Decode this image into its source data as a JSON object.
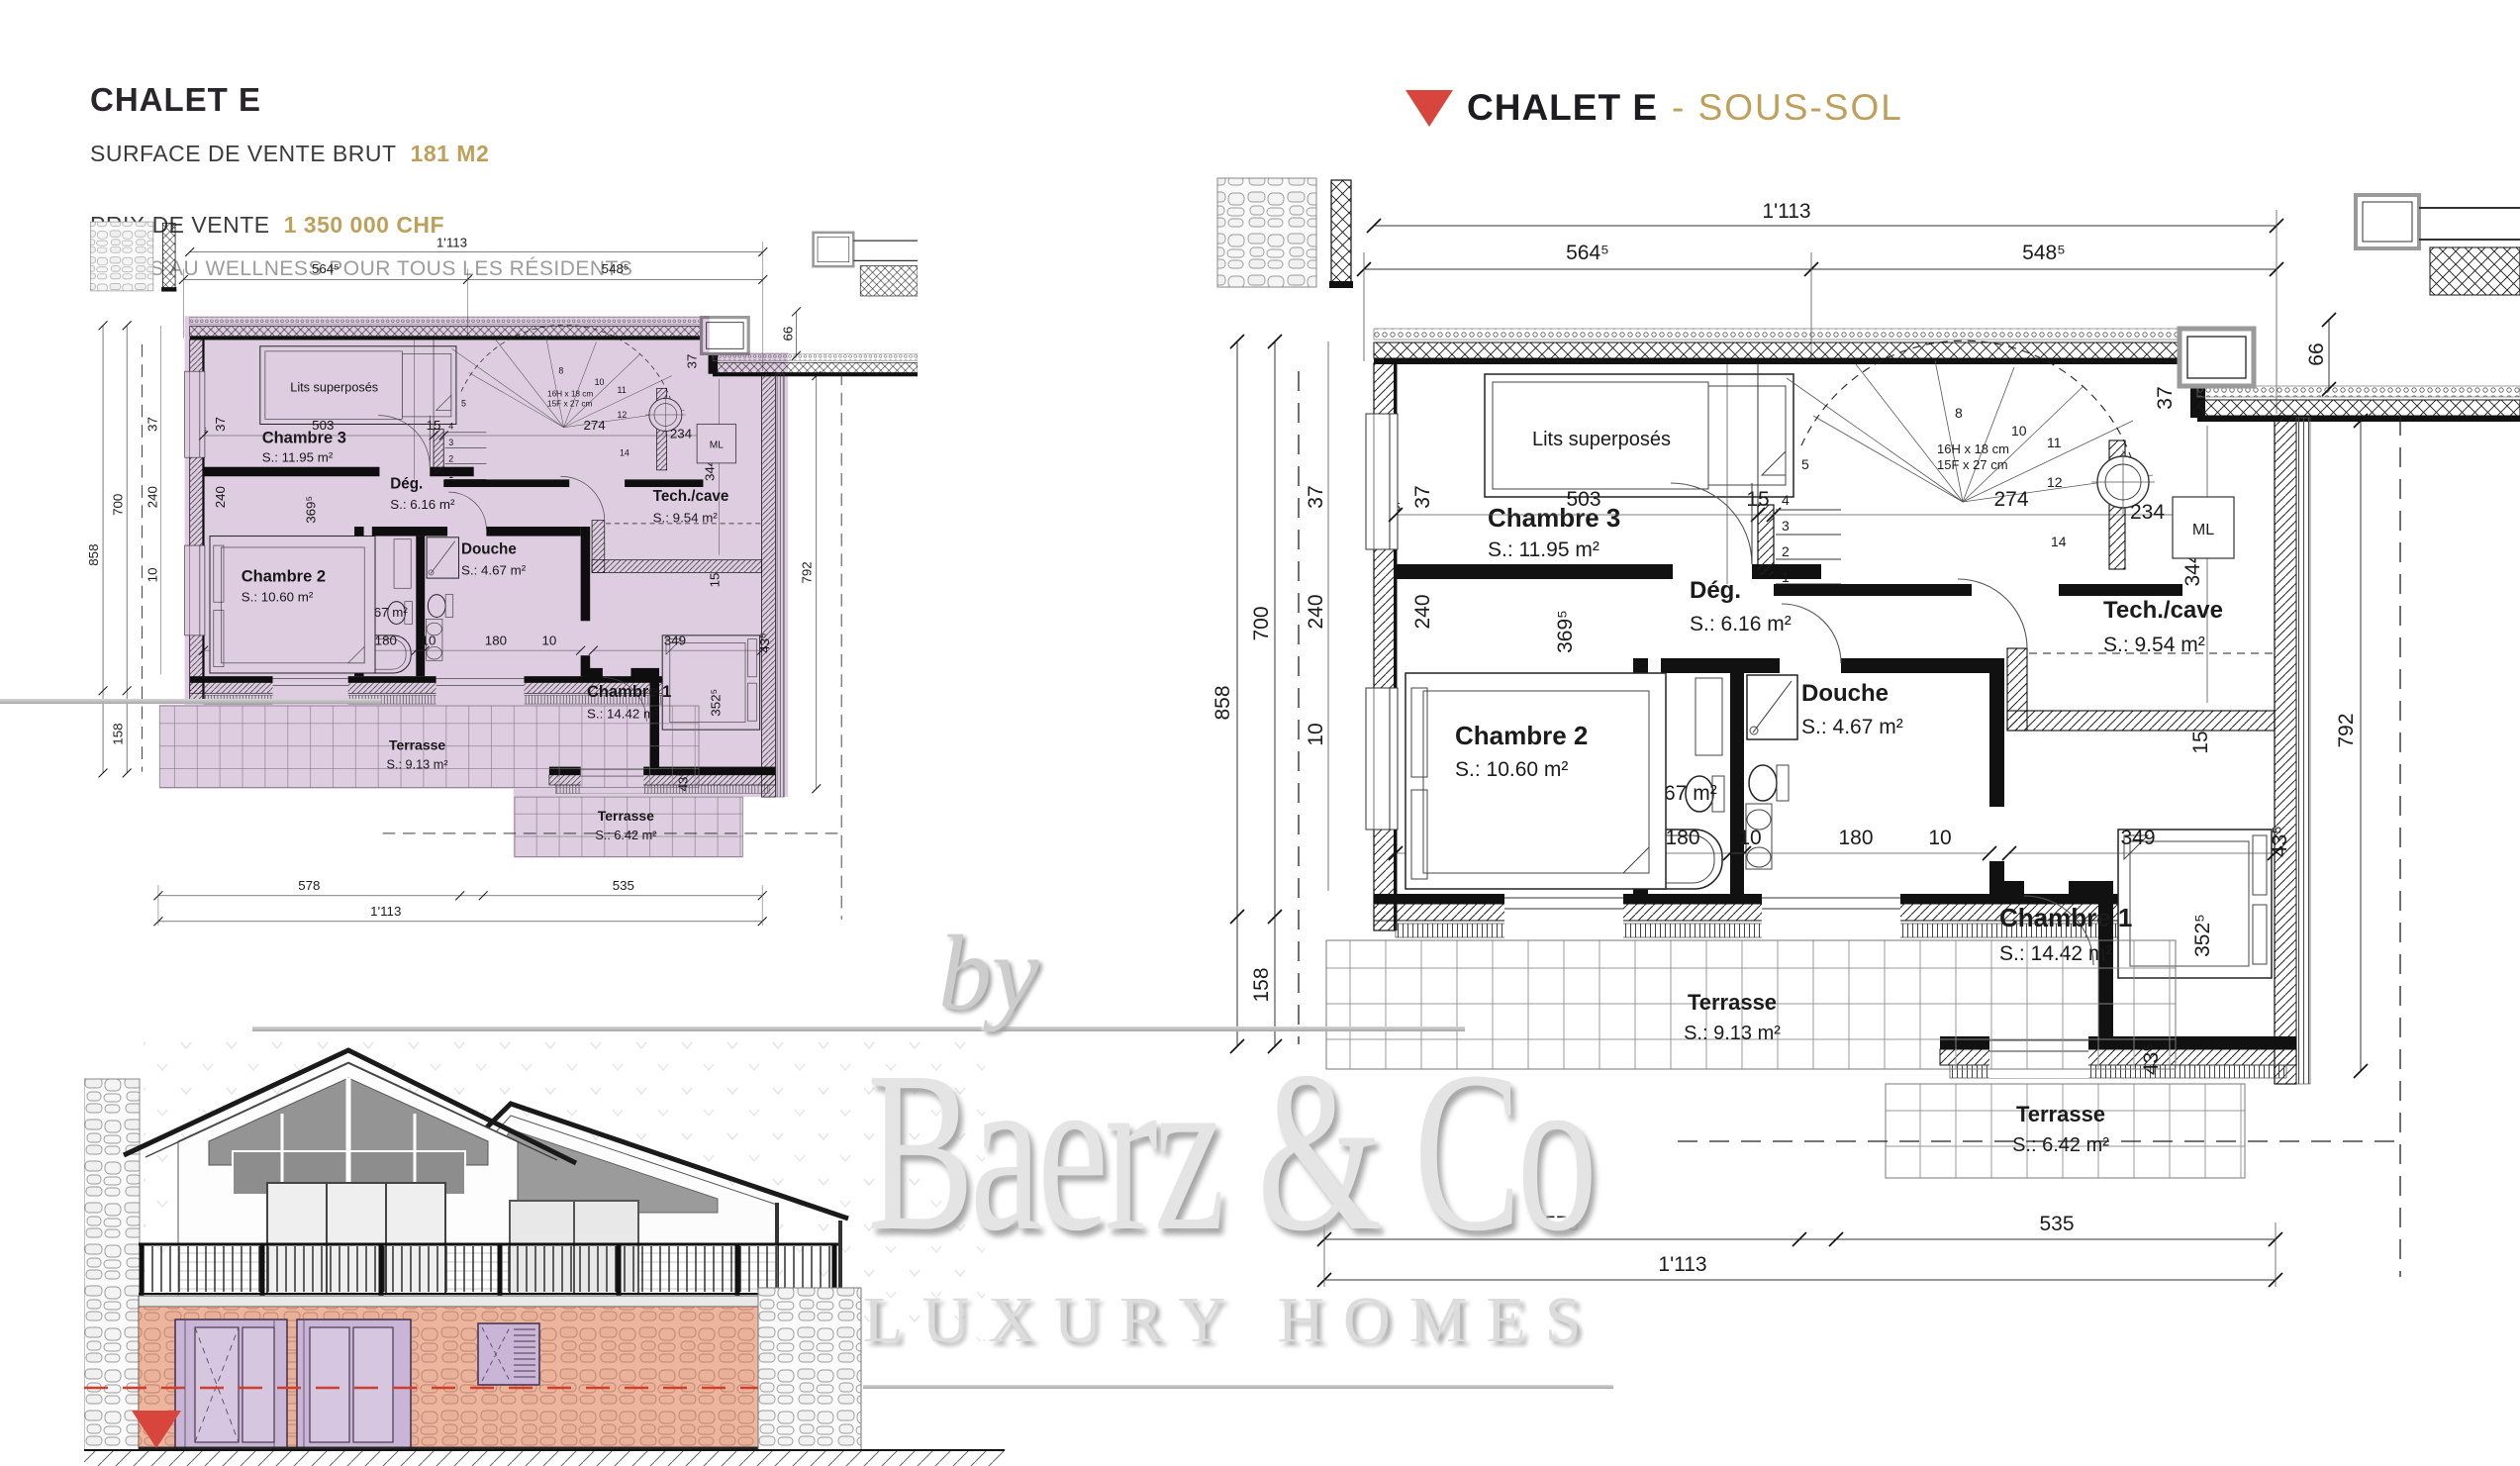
{
  "info_panel": {
    "title": "CHALET E",
    "surface_label": "SURFACE DE VENTE BRUT",
    "surface_value": "181 M2",
    "price_label": "PRIX DE VENTE",
    "price_value": "1 350 000 CHF",
    "note": "ACCÈS AU WELLNESS POUR TOUS LES RÉSIDENTS"
  },
  "plan_header": {
    "title": "CHALET E",
    "subtitle": "- SOUS-SOL"
  },
  "watermark": {
    "by": "by",
    "name": "Baerz & Co",
    "tagline": "LUXURY HOMES"
  },
  "rooms": {
    "chambre3": {
      "name": "Chambre 3",
      "area": "S.: 11.95 m²"
    },
    "chambre2": {
      "name": "Chambre 2",
      "area": "S.: 10.60 m²"
    },
    "chambre1": {
      "name": "Chambre 1",
      "area": "S.: 14.42 m²"
    },
    "bain": {
      "name": "Bain",
      "area": "S.: 4.67 m²"
    },
    "douche": {
      "name": "Douche",
      "area": "S.: 4.67 m²"
    },
    "degagement": {
      "name": "Dég.",
      "area": "S.: 6.16 m²"
    },
    "tech": {
      "name": "Tech./cave",
      "area": "S.: 9.54 m²"
    },
    "terrasse1": {
      "name": "Terrasse",
      "area": "S.: 9.13 m²"
    },
    "terrasse2": {
      "name": "Terrasse",
      "area": "S.: 6.42 m²"
    }
  },
  "annotations": {
    "bunk_beds": "Lits superposés",
    "washing_machine": "ML",
    "stair_note1": "16H x 18 cm",
    "stair_note2": "15F x 27 cm"
  },
  "dims": {
    "total": "1'113",
    "left": "564⁵",
    "right": "548⁵",
    "d66": "66",
    "d37": "37",
    "d240": "240",
    "d10": "10",
    "d43": "43⁵",
    "d700": "700",
    "d858": "858",
    "d158": "158",
    "d369": "369⁵",
    "d503": "503",
    "d15": "15",
    "d274": "274",
    "d234": "234",
    "d287": "287",
    "d180": "180",
    "d344": "344",
    "d349": "349",
    "d352": "352⁵",
    "d792": "792",
    "d578": "578",
    "d535": "535",
    "n1": "1",
    "n2": "2",
    "n3": "3",
    "n4": "4",
    "n5": "5",
    "n8": "8",
    "n10": "10",
    "n11": "11",
    "n12": "12",
    "n14": "14"
  },
  "colors": {
    "accent_gold": "#bfa05a",
    "brand_red": "#d8453c",
    "highlight_purple": "#d9c5dc",
    "highlight_orange": "#e27042",
    "watermark_gray": "#dedede"
  }
}
